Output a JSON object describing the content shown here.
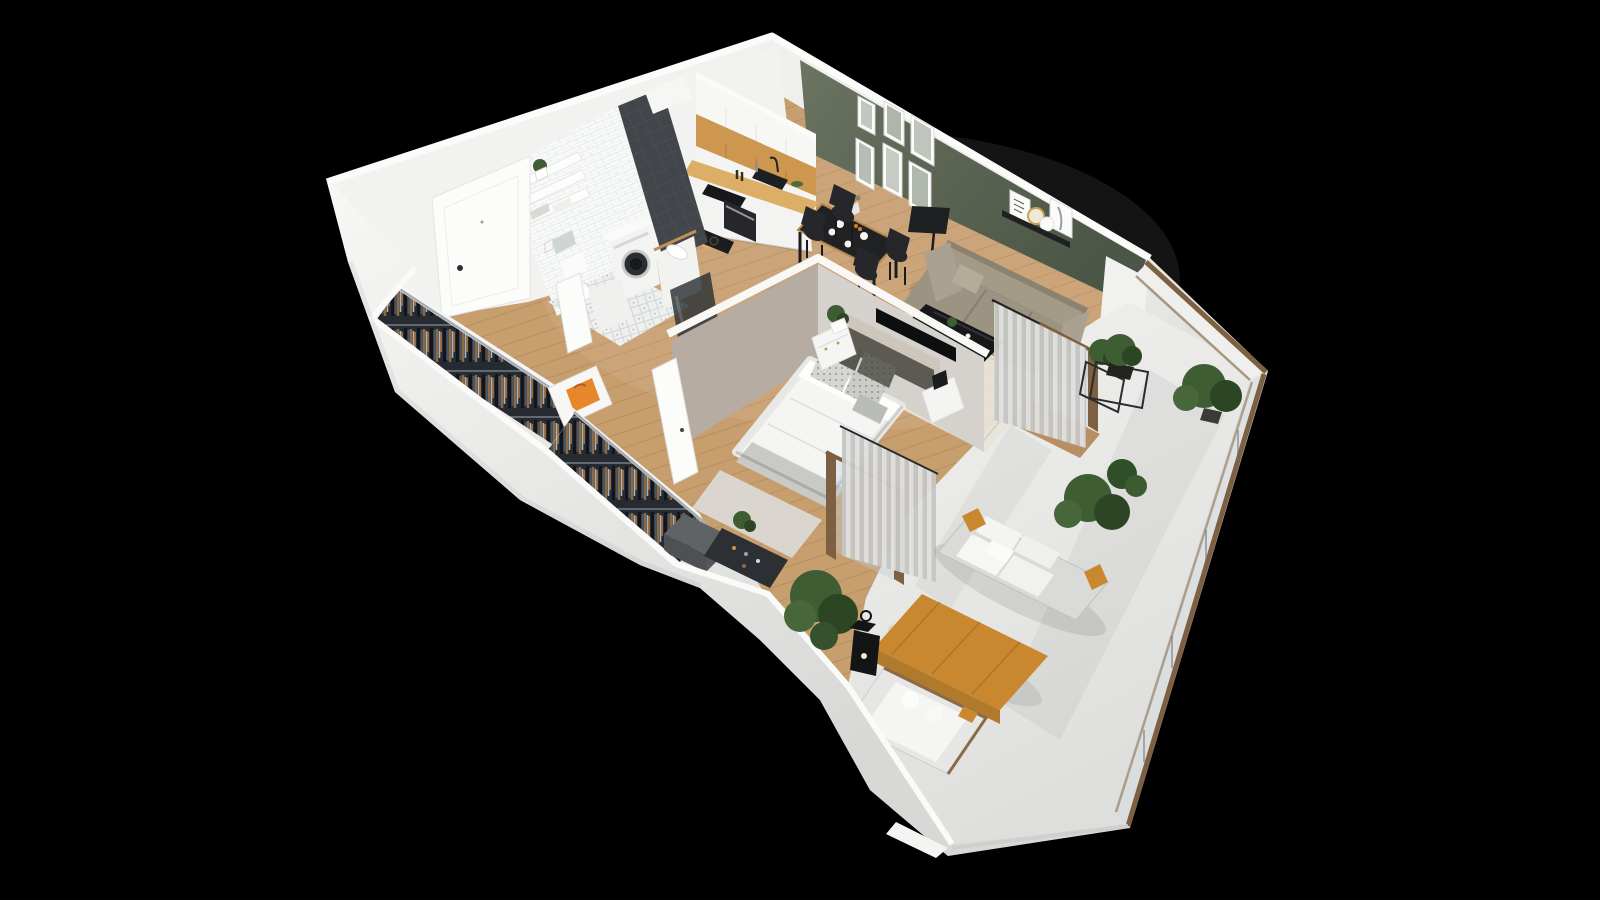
{
  "scene": {
    "type": "3d-isometric-floorplan-render",
    "description": "Photorealistic isometric cutaway render of a one-bedroom apartment with open-plan kitchen/living/dining room, bathroom, entry hall with open wardrobes, bedroom and a large wrap-around terrace, shown on a black background",
    "background": "#000000"
  },
  "colors": {
    "bg": "#000000",
    "wallFace": "#f3f3f1",
    "wallCap": "#fbfbfa",
    "wallShade": "#dddddb",
    "greenWall": "#5f6a57",
    "greenWallDark": "#4c5646",
    "greige": "#b6aca1",
    "greigeLight": "#d5d1cc",
    "woodFloor": "#c79e6e",
    "woodSeam": "#8b5e34",
    "woodCabinet": "#cd9750",
    "counterWood": "#dcae66",
    "bathTile": "#f8f9f9",
    "darkTile": "#42464b",
    "bathFloor": "#eef0ef",
    "black": "#1b1c1e",
    "charcoal": "#26272b",
    "sofa": "#9c9382",
    "sofaDark": "#8b8270",
    "rug": "#e8e4da",
    "bedWhite": "#f5f5f3",
    "headboard": "#5d5a54",
    "clothesRail": "#262a31",
    "orange": "#e8862c",
    "curtain": "#d8d8d6",
    "balconyFloor": "#eaeae8",
    "railWood": "#7d6041",
    "outdoorWood": "#c9882f",
    "plant": "#3f5d33",
    "plantDark": "#2c4624"
  },
  "rooms": [
    {
      "name": "entry-hall",
      "items": [
        "entrance-door",
        "door-handle",
        "open-wardrobe-rail-with-clothes",
        "white-dresser",
        "orange-shopping-bag",
        "wood-plank-floor"
      ]
    },
    {
      "name": "bathroom",
      "items": [
        "white-subway-tile-wall",
        "dark-tile-duct-column",
        "wall-shelves-with-towels",
        "shelf-plant",
        "flush-plate",
        "toilet",
        "washing-machine",
        "vanity-sink",
        "shower-glass-panel",
        "diamond-pattern-tile-floor",
        "open-bathroom-door"
      ]
    },
    {
      "name": "kitchen",
      "items": [
        "white-upper-cabinets",
        "oak-cabinet-row",
        "wood-countertop",
        "black-cooktop",
        "black-sink-with-faucet",
        "oven",
        "white-base-cabinets",
        "record-player",
        "fruit-bowl"
      ]
    },
    {
      "name": "living-dining-room",
      "items": [
        "sage-green-wall",
        "gallery-wall-six-frames",
        "black-picture-ledge-with-prints",
        "black-dining-table-set-for-four",
        "four-black-chairs",
        "black-floor-lamp",
        "taupe-three-seat-sofa",
        "black-coffee-table",
        "cream-rug",
        "sheer-curtains",
        "wood-framed-sliding-door",
        "plant-stand"
      ]
    },
    {
      "name": "bedroom",
      "items": [
        "double-bed-white-duvet",
        "upholstered-headboard",
        "patterned-pillows",
        "nightstand-with-plant",
        "nightstand-with-black-lamp",
        "wall-mounted-tv",
        "gray-rug",
        "open-white-door",
        "closet-rail-with-clothes",
        "gray-ottoman",
        "shoe-rack",
        "curtains",
        "wood-framed-balcony-door"
      ]
    },
    {
      "name": "balcony-terrace",
      "items": [
        "white-terrace-floor",
        "glass-railing-with-wood-handrail",
        "cube-plant-stand",
        "potted-palm",
        "rubber-plant",
        "outdoor-sofa-with-white-cushions",
        "wood-coffee-table",
        "sun-lounger-with-white-cushions",
        "black-candle-lantern",
        "green-shrub",
        "white-parapet-walls"
      ]
    }
  ]
}
